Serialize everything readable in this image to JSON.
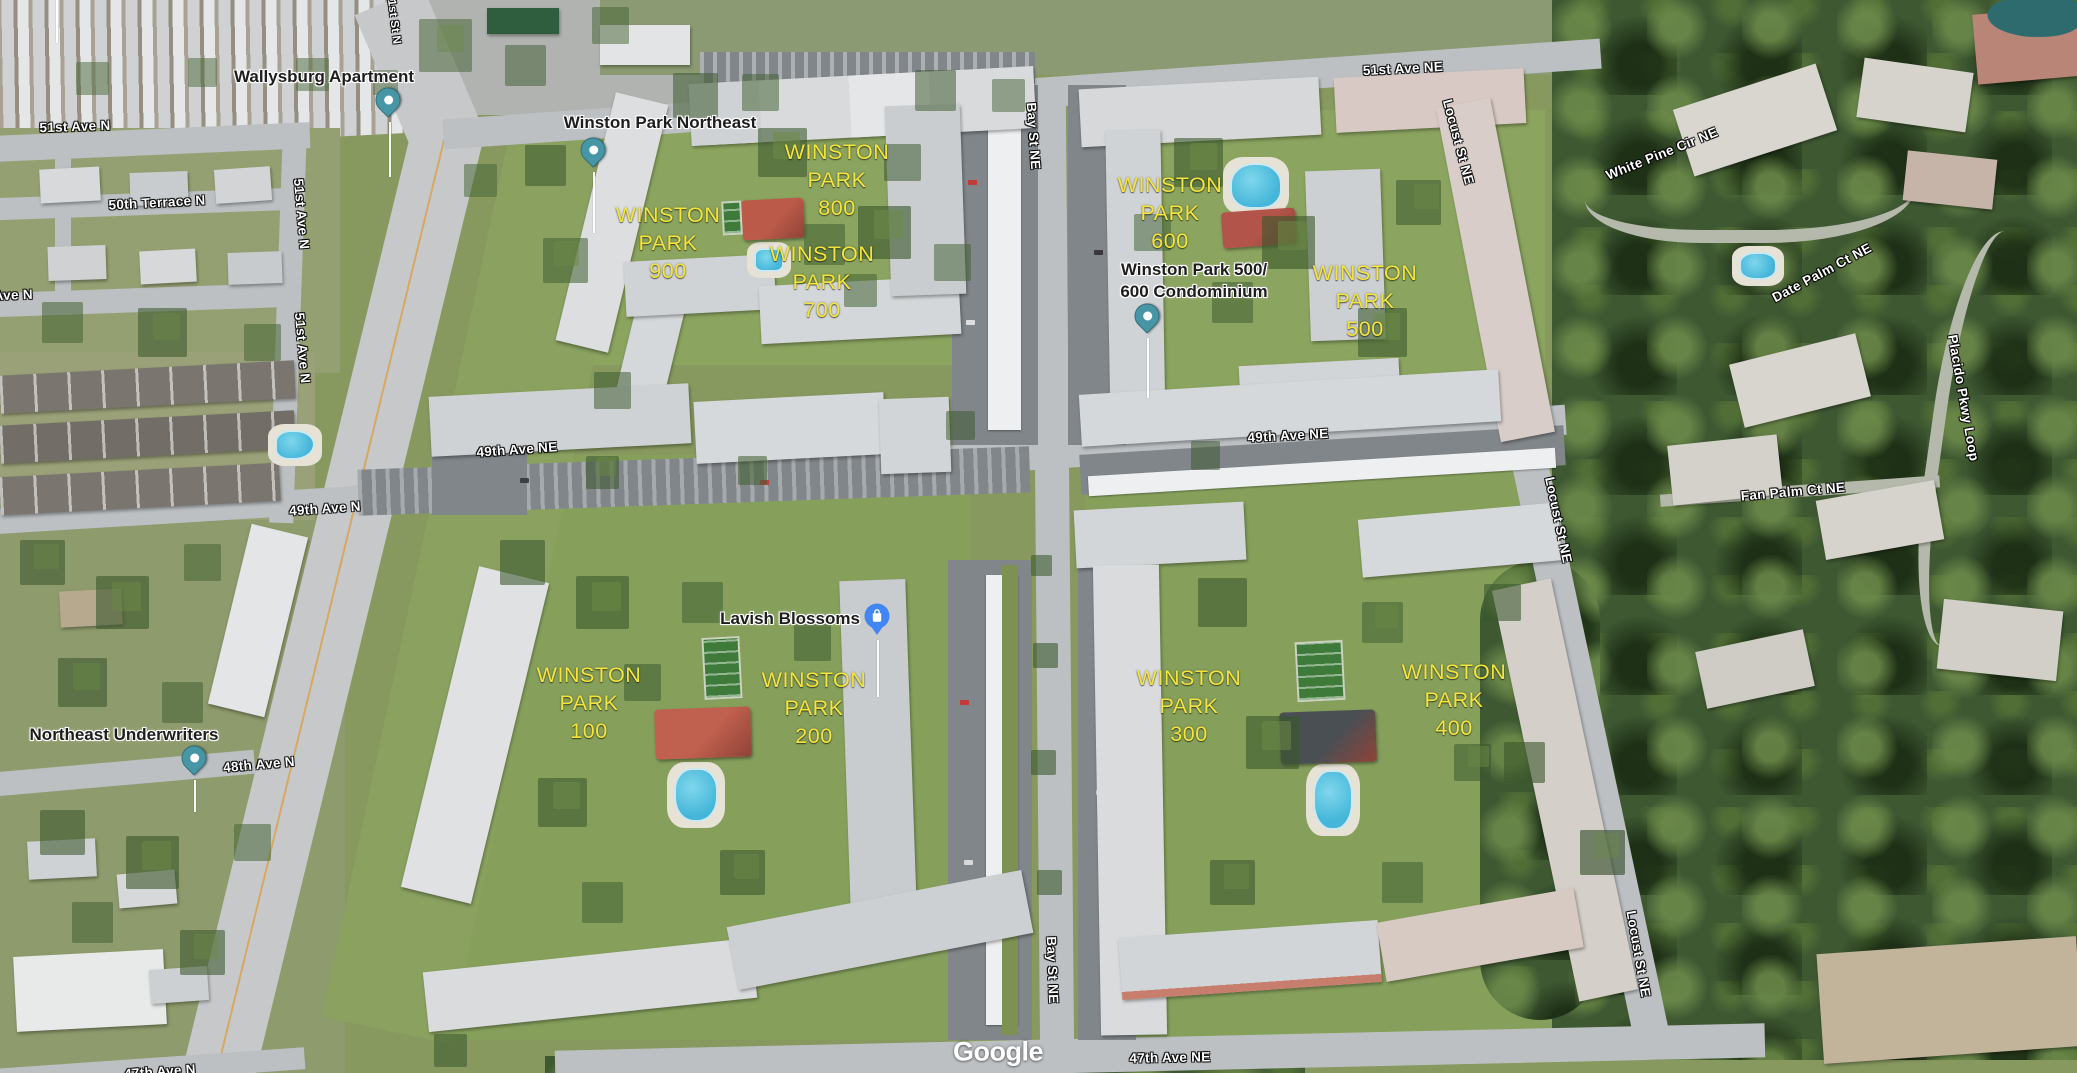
{
  "map": {
    "watermark": "Google",
    "colors": {
      "district_yellow": "#f2e53f",
      "street_text": "#ffffff",
      "place_text": "#1d1d1d",
      "pin_teal": "#4796a6",
      "pin_shop_blue": "#4285f4",
      "pool_water": "#45b6d9",
      "clubhouse_red": "#bb5a49"
    },
    "street_labels": [
      {
        "name": "51st Ave N",
        "x": 75,
        "y": 127,
        "rot": -2
      },
      {
        "name": "50th Terrace N",
        "x": 157,
        "y": 203,
        "rot": -3
      },
      {
        "name": "50th Ave N",
        "x": -3,
        "y": 296,
        "rot": -2
      },
      {
        "name": "49th Ave N",
        "x": 325,
        "y": 509,
        "rot": -4
      },
      {
        "name": "48th Ave N",
        "x": 259,
        "y": 765,
        "rot": -5
      },
      {
        "name": "47th Ave N",
        "x": 160,
        "y": 1072,
        "rot": -4
      },
      {
        "name": "51st Ave N",
        "x": 301,
        "y": 214,
        "rot": 85
      },
      {
        "name": "51st Ave N",
        "x": 302,
        "y": 348,
        "rot": 85
      },
      {
        "name": "1st St N",
        "x": 393,
        "y": 22,
        "rot": 83,
        "size": 11.5
      },
      {
        "name": "51st Ave NE",
        "x": 1403,
        "y": 69,
        "rot": -3
      },
      {
        "name": "Bay St NE",
        "x": 1033,
        "y": 136,
        "rot": 86
      },
      {
        "name": "Bay St NE",
        "x": 1052,
        "y": 970,
        "rot": 88
      },
      {
        "name": "49th Ave NE",
        "x": 517,
        "y": 450,
        "rot": -4
      },
      {
        "name": "49th Ave NE",
        "x": 1288,
        "y": 436,
        "rot": -3
      },
      {
        "name": "Locust St NE",
        "x": 1458,
        "y": 142,
        "rot": 75
      },
      {
        "name": "Locust St NE",
        "x": 1558,
        "y": 520,
        "rot": 78
      },
      {
        "name": "Locust St NE",
        "x": 1638,
        "y": 954,
        "rot": 80
      },
      {
        "name": "47th Ave NE",
        "x": 1170,
        "y": 1058,
        "rot": -1
      },
      {
        "name": "White Pine Cir NE",
        "x": 1662,
        "y": 154,
        "rot": -22
      },
      {
        "name": "Date Palm Ct NE",
        "x": 1822,
        "y": 273,
        "rot": -28
      },
      {
        "name": "Fan Palm Ct NE",
        "x": 1793,
        "y": 492,
        "rot": -5
      },
      {
        "name": "Placido Pkwy Loop",
        "x": 1963,
        "y": 398,
        "rot": 80
      }
    ],
    "place_labels": [
      {
        "id": "wallysburg-apartment",
        "lines": [
          "Wallysburg Apartment"
        ],
        "x": 324,
        "y": 77,
        "pin": {
          "type": "teal",
          "x": 388,
          "y": 100
        },
        "stem": {
          "x": 389,
          "y1": 122,
          "y2": 177
        }
      },
      {
        "id": "winston-park-northeast",
        "lines": [
          "Winston Park Northeast"
        ],
        "x": 660,
        "y": 123,
        "pin": {
          "type": "teal",
          "x": 593,
          "y": 150
        },
        "stem": {
          "x": 593,
          "y1": 172,
          "y2": 233
        }
      },
      {
        "id": "winston-park-500-600-condominium",
        "lines": [
          "Winston Park 500/",
          "600 Condominium"
        ],
        "x": 1194,
        "y": 281,
        "pin": {
          "type": "teal",
          "x": 1147,
          "y": 316
        },
        "stem": {
          "x": 1147,
          "y1": 338,
          "y2": 398
        }
      },
      {
        "id": "northeast-underwriters",
        "lines": [
          "Northeast Underwriters"
        ],
        "x": 124,
        "y": 735,
        "pin": {
          "type": "teal",
          "x": 194,
          "y": 758
        },
        "stem": {
          "x": 194,
          "y1": 780,
          "y2": 812
        }
      },
      {
        "id": "lavish-blossoms",
        "lines": [
          "Lavish Blossoms"
        ],
        "x": 790,
        "y": 619,
        "pin": {
          "type": "shop",
          "x": 877,
          "y": 616
        },
        "stem": {
          "x": 877,
          "y1": 640,
          "y2": 697
        }
      }
    ],
    "district_labels": [
      {
        "id": "winston-park-900",
        "lines": [
          "WINSTON",
          "PARK",
          "900"
        ],
        "x": 668,
        "y": 243
      },
      {
        "id": "winston-park-800",
        "lines": [
          "WINSTON",
          "PARK",
          "800"
        ],
        "x": 837,
        "y": 180
      },
      {
        "id": "winston-park-700",
        "lines": [
          "WINSTON",
          "PARK",
          "700"
        ],
        "x": 822,
        "y": 282
      },
      {
        "id": "winston-park-600",
        "lines": [
          "WINSTON",
          "PARK",
          "600"
        ],
        "x": 1170,
        "y": 213
      },
      {
        "id": "winston-park-500",
        "lines": [
          "WINSTON",
          "PARK",
          "500"
        ],
        "x": 1365,
        "y": 301
      },
      {
        "id": "winston-park-100",
        "lines": [
          "WINSTON",
          "PARK",
          "100"
        ],
        "x": 589,
        "y": 703
      },
      {
        "id": "winston-park-200",
        "lines": [
          "WINSTON",
          "PARK",
          "200"
        ],
        "x": 814,
        "y": 708
      },
      {
        "id": "winston-park-300",
        "lines": [
          "WINSTON",
          "PARK",
          "300"
        ],
        "x": 1189,
        "y": 706
      },
      {
        "id": "winston-park-400",
        "lines": [
          "WINSTON",
          "PARK",
          "400"
        ],
        "x": 1454,
        "y": 700
      }
    ],
    "features": {
      "pools": [
        {
          "x": 295,
          "y": 445,
          "w": 36,
          "h": 26,
          "r": "45% 55% 60% 40%"
        },
        {
          "x": 769,
          "y": 260,
          "w": 26,
          "h": 20,
          "r": "30%"
        },
        {
          "x": 1256,
          "y": 186,
          "w": 48,
          "h": 42,
          "r": "45% 45% 40% 40%"
        },
        {
          "x": 696,
          "y": 795,
          "w": 40,
          "h": 50,
          "r": "40% 40% 45% 45%"
        },
        {
          "x": 1333,
          "y": 800,
          "w": 36,
          "h": 56,
          "r": "40% 40% 45% 45%"
        },
        {
          "x": 1758,
          "y": 266,
          "w": 34,
          "h": 24,
          "r": "40%"
        }
      ],
      "clubhouses": [
        {
          "x": 773,
          "y": 219,
          "w": 62,
          "h": 40,
          "color": "#bb5a49",
          "rot": -3
        },
        {
          "x": 1259,
          "y": 228,
          "w": 74,
          "h": 36,
          "color": "#b2544a",
          "rot": -4
        },
        {
          "x": 703,
          "y": 733,
          "w": 96,
          "h": 50,
          "color": "#c0604e",
          "rot": -2
        },
        {
          "x": 1328,
          "y": 737,
          "w": 96,
          "h": 52,
          "color": "#4a4f54",
          "rot": -2
        }
      ],
      "courts": [
        {
          "x": 732,
          "y": 218,
          "w": 16,
          "h": 30
        },
        {
          "x": 722,
          "y": 668,
          "w": 34,
          "h": 58
        },
        {
          "x": 1320,
          "y": 671,
          "w": 44,
          "h": 56
        }
      ],
      "pond": {
        "x": 2035,
        "y": 16,
        "w": 95,
        "h": 42
      }
    }
  }
}
